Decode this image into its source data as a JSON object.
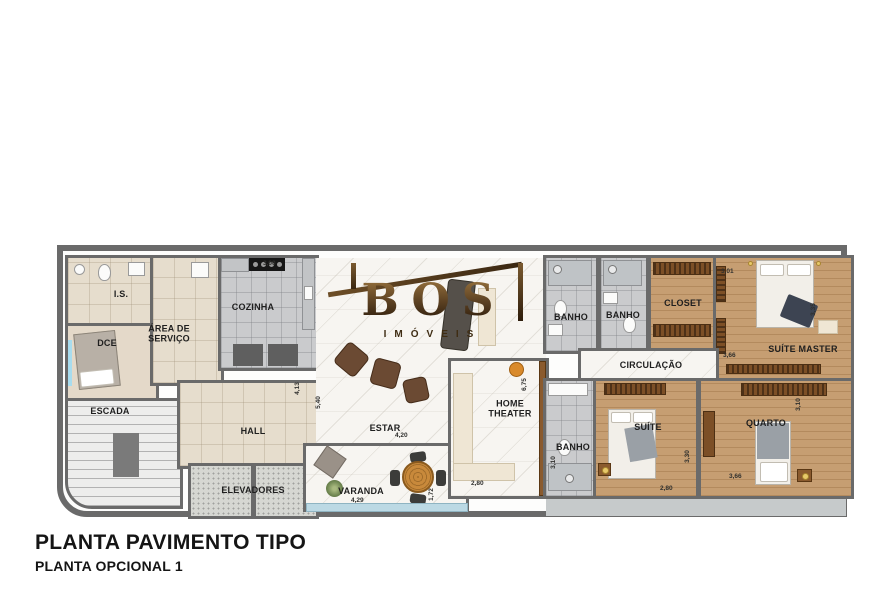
{
  "meta": {
    "title": "PLANTA PAVIMENTO TIPO",
    "subtitle": "PLANTA OPCIONAL 1"
  },
  "logo": {
    "brand": "BOS",
    "tagline": "IMÓVEIS"
  },
  "colors": {
    "wall": "#6a6a6a",
    "wood_floor": "#c69e72",
    "logo_bronze": "#5d4223",
    "glass": "#bcd9e4"
  },
  "rooms": {
    "is": {
      "label": "I.S."
    },
    "dce": {
      "label": "DCE"
    },
    "area_servico": {
      "label": "ÁREA DE SERVIÇO"
    },
    "cozinha": {
      "label": "COZINHA",
      "top": "3,00",
      "right": "4,13"
    },
    "escada": {
      "label": "ESCADA"
    },
    "hall": {
      "label": "HALL"
    },
    "elevadores": {
      "label": "ELEVADORES"
    },
    "estar": {
      "label": "ESTAR",
      "bottom": "4,20",
      "left": "5,40"
    },
    "varanda": {
      "label": "VARANDA",
      "bottom": "4,29",
      "right": "1,72"
    },
    "home_theater": {
      "label": "HOME THEATER",
      "bottom": "2,80",
      "right": "6,75"
    },
    "banho_top1": {
      "label": "BANHO"
    },
    "banho_top2": {
      "label": "BANHO"
    },
    "closet": {
      "label": "CLOSET"
    },
    "circulacao": {
      "label": "CIRCULAÇÃO"
    },
    "suite_master": {
      "label": "SUÍTE MASTER",
      "top": "3,01",
      "right": "3,35",
      "bottom": "3,66"
    },
    "banho_bottom": {
      "label": "BANHO",
      "left": "3,10"
    },
    "suite": {
      "label": "SUÍTE",
      "bottom": "2,80",
      "right": "3,30"
    },
    "quarto": {
      "label": "QUARTO",
      "right": "3,10",
      "bottom": "3,66"
    }
  }
}
